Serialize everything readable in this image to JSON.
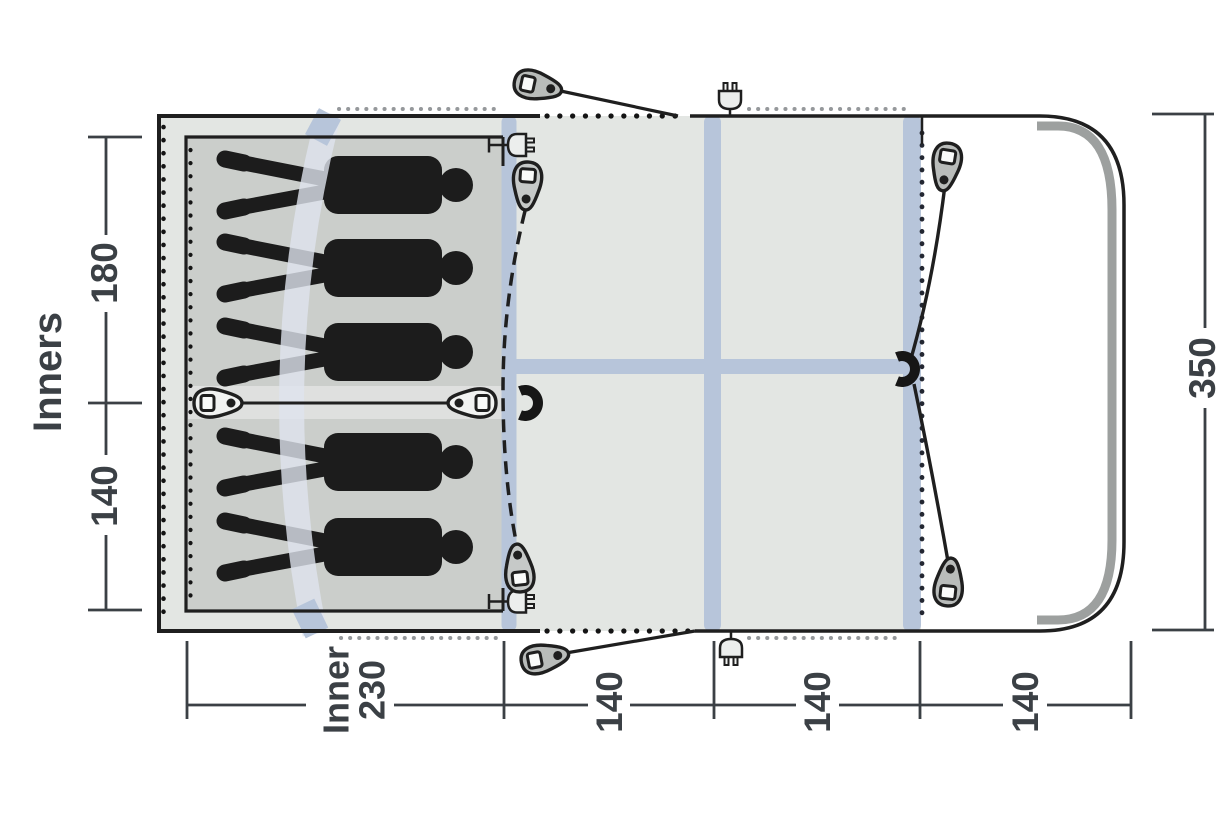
{
  "diagram": {
    "type": "tent-floorplan-top-view",
    "side_label": "Inners",
    "sleeper_count": 5,
    "dims": {
      "left_top": "180",
      "left_bottom": "140",
      "right": "350",
      "bottom_inner_line1": "Inner",
      "bottom_inner_line2": "230",
      "bottom_140_a": "140",
      "bottom_140_b": "140",
      "bottom_140_c": "140"
    },
    "icons": [
      "guyline-peg-icon",
      "power-plug-icon",
      "magnet-clip-icon",
      "divider-toggle-icon",
      "person-silhouette"
    ],
    "colors": {
      "beam_blue": "#b7c5da",
      "pale_beam": "#dee4ee",
      "tent_gray": "#e3e6e3",
      "inner_gray": "#cbcecb",
      "entrance_white": "#ffffff",
      "pole_gray": "#9da09f",
      "outline_black": "#1f1f1f",
      "dimension_text": "#3b4045",
      "silhouette": "#1c1c1c"
    }
  }
}
